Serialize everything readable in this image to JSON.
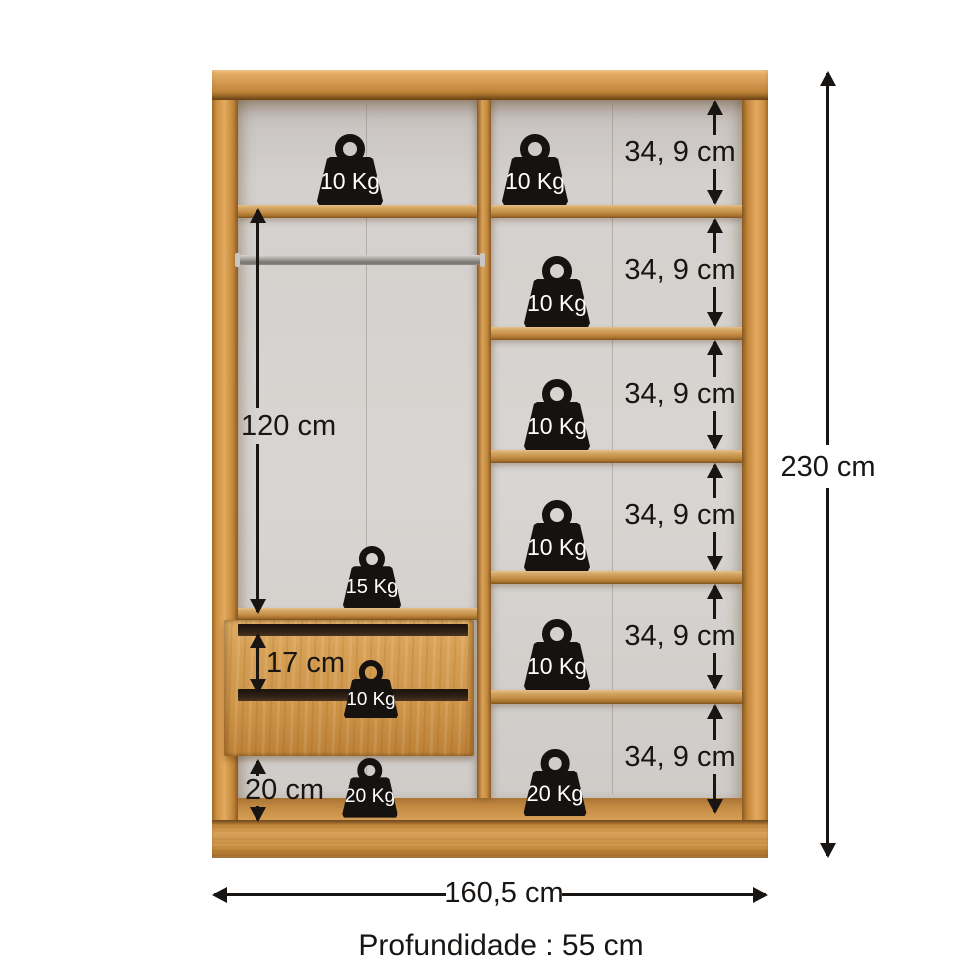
{
  "colors": {
    "wood": "#d69c54",
    "wood_light": "#e9bc79",
    "wood_dark": "#a9742f",
    "wood_deep": "#7e521d",
    "interior": "#d2cecb",
    "ink": "#181512",
    "weight_fill": "#151210",
    "weight_text": "#ffffff",
    "rod": "#8e8a86"
  },
  "annotations": {
    "shelf_sizes": [
      "34, 9 cm",
      "34, 9 cm",
      "34, 9 cm",
      "34, 9 cm",
      "34, 9 cm",
      "34, 9 cm"
    ],
    "hanging_height": "120 cm",
    "drawer_height": "17 cm",
    "bottom_height": "20 cm",
    "total_height": "230 cm",
    "total_width": "160,5 cm",
    "depth": "Profundidade : 55 cm"
  },
  "weights": {
    "top_left": "10 Kg",
    "shelf_1": "10 Kg",
    "shelf_2": "10 Kg",
    "shelf_3": "10 Kg",
    "shelf_4": "10 Kg",
    "shelf_5": "10 Kg",
    "shelf_6": "20 Kg",
    "hanging": "15 Kg",
    "drawer": "10 Kg",
    "bottom_left": "20 Kg"
  }
}
